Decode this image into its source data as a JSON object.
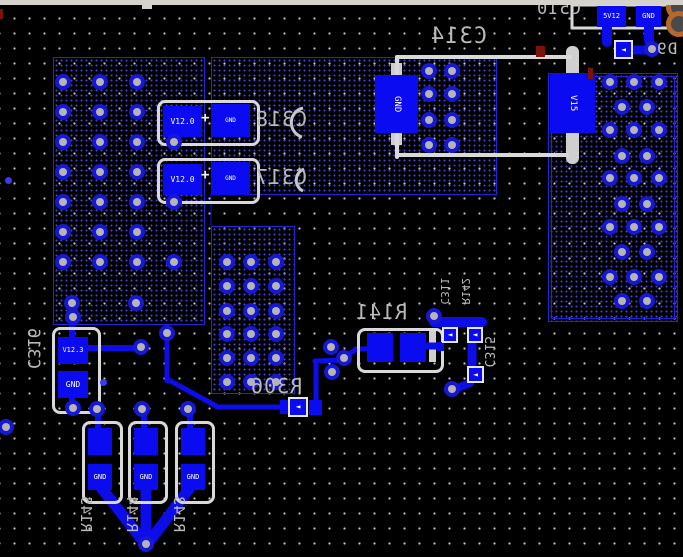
{
  "board": {
    "width": 683,
    "height": 557,
    "colors": {
      "background": "#000000",
      "pad_blue": "#0b0bf2",
      "trace_blue": "#0d0dea",
      "via_ring": "#1717d6",
      "via_hole": "#b5b5b5",
      "silk_gray": "#d9d9d9",
      "designator_gray": "#b9b9b9",
      "region_border": "#2525d8",
      "orange_pad": "#b4672f",
      "red_mark": "#7a1408",
      "titlebar_gray": "#d5d2cb"
    },
    "titlebar": {
      "height": 5,
      "tab": [
        142,
        4,
        10,
        5
      ]
    },
    "regions": [
      [
        53,
        57,
        150,
        266,
        0
      ],
      [
        211,
        57,
        284,
        136,
        0
      ],
      [
        211,
        226,
        82,
        166,
        0
      ],
      [
        548,
        73,
        128,
        247,
        1
      ]
    ],
    "vias": [
      [
        63,
        82
      ],
      [
        100,
        82
      ],
      [
        137,
        82
      ],
      [
        63,
        112
      ],
      [
        100,
        112
      ],
      [
        137,
        112
      ],
      [
        63,
        142
      ],
      [
        100,
        142
      ],
      [
        137,
        142
      ],
      [
        174,
        142
      ],
      [
        63,
        172
      ],
      [
        100,
        172
      ],
      [
        137,
        172
      ],
      [
        63,
        202
      ],
      [
        100,
        202
      ],
      [
        137,
        202
      ],
      [
        174,
        202
      ],
      [
        63,
        232
      ],
      [
        100,
        232
      ],
      [
        137,
        232
      ],
      [
        63,
        262
      ],
      [
        100,
        262
      ],
      [
        137,
        262
      ],
      [
        174,
        262
      ],
      [
        72,
        303
      ],
      [
        136,
        303
      ],
      [
        429,
        71
      ],
      [
        452,
        71
      ],
      [
        429,
        94
      ],
      [
        452,
        94
      ],
      [
        429,
        120
      ],
      [
        452,
        120
      ],
      [
        429,
        145
      ],
      [
        452,
        145
      ],
      [
        227,
        262
      ],
      [
        251,
        262
      ],
      [
        276,
        262
      ],
      [
        227,
        286
      ],
      [
        251,
        286
      ],
      [
        276,
        286
      ],
      [
        227,
        311
      ],
      [
        251,
        311
      ],
      [
        276,
        311
      ],
      [
        227,
        334
      ],
      [
        251,
        334
      ],
      [
        276,
        334
      ],
      [
        227,
        358
      ],
      [
        251,
        358
      ],
      [
        276,
        358
      ],
      [
        227,
        382
      ],
      [
        251,
        382
      ],
      [
        276,
        382
      ],
      [
        610,
        82
      ],
      [
        634,
        82
      ],
      [
        659,
        82
      ],
      [
        622,
        107
      ],
      [
        647,
        107
      ],
      [
        610,
        130
      ],
      [
        634,
        130
      ],
      [
        659,
        130
      ],
      [
        622,
        156
      ],
      [
        647,
        156
      ],
      [
        610,
        178
      ],
      [
        634,
        178
      ],
      [
        659,
        178
      ],
      [
        622,
        204
      ],
      [
        647,
        204
      ],
      [
        610,
        227
      ],
      [
        634,
        227
      ],
      [
        659,
        227
      ],
      [
        622,
        252
      ],
      [
        647,
        252
      ],
      [
        610,
        277
      ],
      [
        634,
        277
      ],
      [
        659,
        277
      ],
      [
        622,
        301
      ],
      [
        647,
        301
      ],
      [
        652,
        49
      ],
      [
        73,
        317
      ],
      [
        141,
        347
      ],
      [
        167,
        333
      ],
      [
        331,
        347
      ],
      [
        344,
        358
      ],
      [
        332,
        372
      ],
      [
        434,
        316
      ],
      [
        452,
        389
      ],
      [
        73,
        408
      ],
      [
        97,
        409
      ],
      [
        142,
        409
      ],
      [
        188,
        409
      ],
      [
        146,
        544
      ],
      [
        6,
        427
      ]
    ],
    "dots": [
      [
        8,
        180
      ],
      [
        103,
        382
      ]
    ],
    "traces": [
      [
        607,
        27,
        607,
        42,
        10
      ],
      [
        649,
        27,
        649,
        41,
        10
      ],
      [
        631,
        50,
        650,
        50,
        9
      ],
      [
        344,
        357,
        357,
        349,
        5
      ],
      [
        355,
        349,
        369,
        349,
        5
      ],
      [
        424,
        346,
        436,
        346,
        7
      ],
      [
        434,
        322,
        482,
        322,
        10
      ],
      [
        472,
        344,
        472,
        367,
        9
      ],
      [
        470,
        383,
        455,
        389,
        8
      ],
      [
        316,
        401,
        316,
        362,
        5
      ],
      [
        315,
        361,
        342,
        360,
        5
      ],
      [
        284,
        407,
        217,
        407,
        5
      ],
      [
        218,
        407,
        167,
        379,
        5
      ],
      [
        167,
        381,
        167,
        337,
        5
      ],
      [
        72,
        338,
        72,
        319,
        6
      ],
      [
        88,
        348,
        139,
        348,
        6
      ],
      [
        72,
        395,
        72,
        407,
        6
      ],
      [
        98,
        429,
        98,
        411,
        6
      ],
      [
        144,
        429,
        144,
        411,
        6
      ],
      [
        190,
        429,
        190,
        411,
        6
      ],
      [
        99,
        485,
        144,
        542,
        11
      ],
      [
        146,
        485,
        146,
        542,
        11
      ],
      [
        192,
        485,
        149,
        542,
        11
      ],
      [
        211,
        193,
        211,
        226,
        1
      ]
    ],
    "silk_lines": [
      [
        572,
        5,
        683,
        5,
        3
      ],
      [
        572,
        5,
        572,
        28,
        3
      ],
      [
        572,
        28,
        675,
        28,
        3
      ],
      [
        397,
        57,
        570,
        57,
        4
      ],
      [
        397,
        57,
        397,
        157,
        4
      ],
      [
        397,
        155,
        567,
        155,
        4
      ]
    ],
    "silk_rects": [
      [
        566,
        46,
        13,
        118,
        6
      ],
      [
        391,
        63,
        11,
        13,
        0
      ],
      [
        391,
        132,
        11,
        13,
        0
      ],
      [
        429,
        328,
        7,
        34,
        0
      ]
    ],
    "silk_arcs": [
      "M303,108 A15,15 0 0 0 302,137",
      "M304,169 A12,12 0 0 0 303,191"
    ],
    "outlines": [
      [
        157,
        100,
        97,
        40
      ],
      [
        157,
        158,
        97,
        40
      ],
      [
        357,
        328,
        81,
        39
      ],
      [
        52,
        327,
        43,
        81
      ],
      [
        82,
        421,
        35,
        77
      ],
      [
        128,
        421,
        34,
        77
      ],
      [
        175,
        421,
        34,
        77
      ]
    ],
    "pads": [
      {
        "x": 597,
        "y": 6,
        "w": 29,
        "h": 21,
        "label": "5V12",
        "fs": 7,
        "lo": "h"
      },
      {
        "x": 636,
        "y": 6,
        "w": 25,
        "h": 21,
        "label": "GND",
        "fs": 7,
        "lo": "h"
      },
      {
        "x": 375,
        "y": 75,
        "w": 43,
        "h": 58,
        "label": "GND",
        "fs": 9,
        "lo": "v"
      },
      {
        "x": 550,
        "y": 73,
        "w": 45,
        "h": 60,
        "label": "V15",
        "fs": 9,
        "lo": "v"
      },
      {
        "x": 163,
        "y": 106,
        "w": 39,
        "h": 31,
        "label": "V12.0",
        "fs": 8,
        "lo": "h"
      },
      {
        "x": 211,
        "y": 104,
        "w": 39,
        "h": 33,
        "label": "GND",
        "fs": 6,
        "lo": "h"
      },
      {
        "x": 163,
        "y": 164,
        "w": 39,
        "h": 31,
        "label": "V12.0",
        "fs": 8,
        "lo": "h"
      },
      {
        "x": 211,
        "y": 162,
        "w": 39,
        "h": 33,
        "label": "GND",
        "fs": 6,
        "lo": "h"
      },
      {
        "x": 367,
        "y": 333,
        "w": 26,
        "h": 29
      },
      {
        "x": 400,
        "y": 333,
        "w": 26,
        "h": 29
      },
      {
        "x": 58,
        "y": 337,
        "w": 30,
        "h": 27,
        "label": "V12.3",
        "fs": 7,
        "lo": "h"
      },
      {
        "x": 58,
        "y": 371,
        "w": 30,
        "h": 27,
        "label": "GND",
        "fs": 8,
        "lo": "h"
      },
      {
        "x": 88,
        "y": 428,
        "w": 24,
        "h": 27
      },
      {
        "x": 134,
        "y": 428,
        "w": 24,
        "h": 27
      },
      {
        "x": 181,
        "y": 428,
        "w": 24,
        "h": 27
      },
      {
        "x": 88,
        "y": 464,
        "w": 24,
        "h": 26,
        "label": "GND",
        "fs": 7,
        "lo": "h"
      },
      {
        "x": 134,
        "y": 464,
        "w": 24,
        "h": 26,
        "label": "GND",
        "fs": 7,
        "lo": "h"
      },
      {
        "x": 181,
        "y": 464,
        "w": 24,
        "h": 26,
        "label": "GND",
        "fs": 7,
        "lo": "h"
      },
      {
        "x": 280,
        "y": 400,
        "w": 10,
        "h": 14
      },
      {
        "x": 309,
        "y": 400,
        "w": 13,
        "h": 15
      },
      {
        "x": 437,
        "y": 342,
        "w": 7,
        "h": 9
      }
    ],
    "markers": {
      "glyph": "◄",
      "items": [
        [
          614,
          40,
          19
        ],
        [
          442,
          327,
          16
        ],
        [
          467,
          327,
          16
        ],
        [
          467,
          366,
          17
        ],
        [
          288,
          397,
          20
        ]
      ]
    },
    "plus": {
      "glyph": "+",
      "items": [
        [
          201,
          111
        ],
        [
          201,
          168
        ]
      ]
    },
    "designators": [
      {
        "text": "C510",
        "x": 536,
        "y": 1,
        "fs": 17,
        "o": "h"
      },
      {
        "text": "D9",
        "x": 656,
        "y": 41,
        "fs": 16,
        "o": "h"
      },
      {
        "text": "C314",
        "x": 430,
        "y": 26,
        "fs": 22,
        "o": "h"
      },
      {
        "text": "C318",
        "x": 255,
        "y": 109,
        "fs": 20,
        "o": "h"
      },
      {
        "text": "C317",
        "x": 255,
        "y": 167,
        "fs": 20,
        "o": "h"
      },
      {
        "text": "R141",
        "x": 355,
        "y": 302,
        "fs": 20,
        "o": "h"
      },
      {
        "text": "C311",
        "x": 439,
        "y": 278,
        "fs": 11,
        "o": "v"
      },
      {
        "text": "R142",
        "x": 460,
        "y": 278,
        "fs": 11,
        "o": "v"
      },
      {
        "text": "C315",
        "x": 482,
        "y": 336,
        "fs": 13,
        "o": "v"
      },
      {
        "text": "R306",
        "x": 250,
        "y": 376,
        "fs": 20,
        "o": "h"
      },
      {
        "text": "C316",
        "x": 24,
        "y": 328,
        "fs": 17,
        "o": "v"
      },
      {
        "text": "R145",
        "x": 78,
        "y": 496,
        "fs": 15,
        "o": "v"
      },
      {
        "text": "R144",
        "x": 124,
        "y": 496,
        "fs": 15,
        "o": "v"
      },
      {
        "text": "R143",
        "x": 171,
        "y": 496,
        "fs": 15,
        "o": "v"
      }
    ],
    "decor": {
      "orange_pads": [
        [
          666,
          -6,
          26
        ],
        [
          666,
          11,
          26
        ]
      ],
      "red_marks": [
        [
          536,
          46,
          9,
          11
        ],
        [
          588,
          68,
          5,
          11
        ],
        [
          0,
          9,
          3,
          10
        ]
      ]
    }
  }
}
